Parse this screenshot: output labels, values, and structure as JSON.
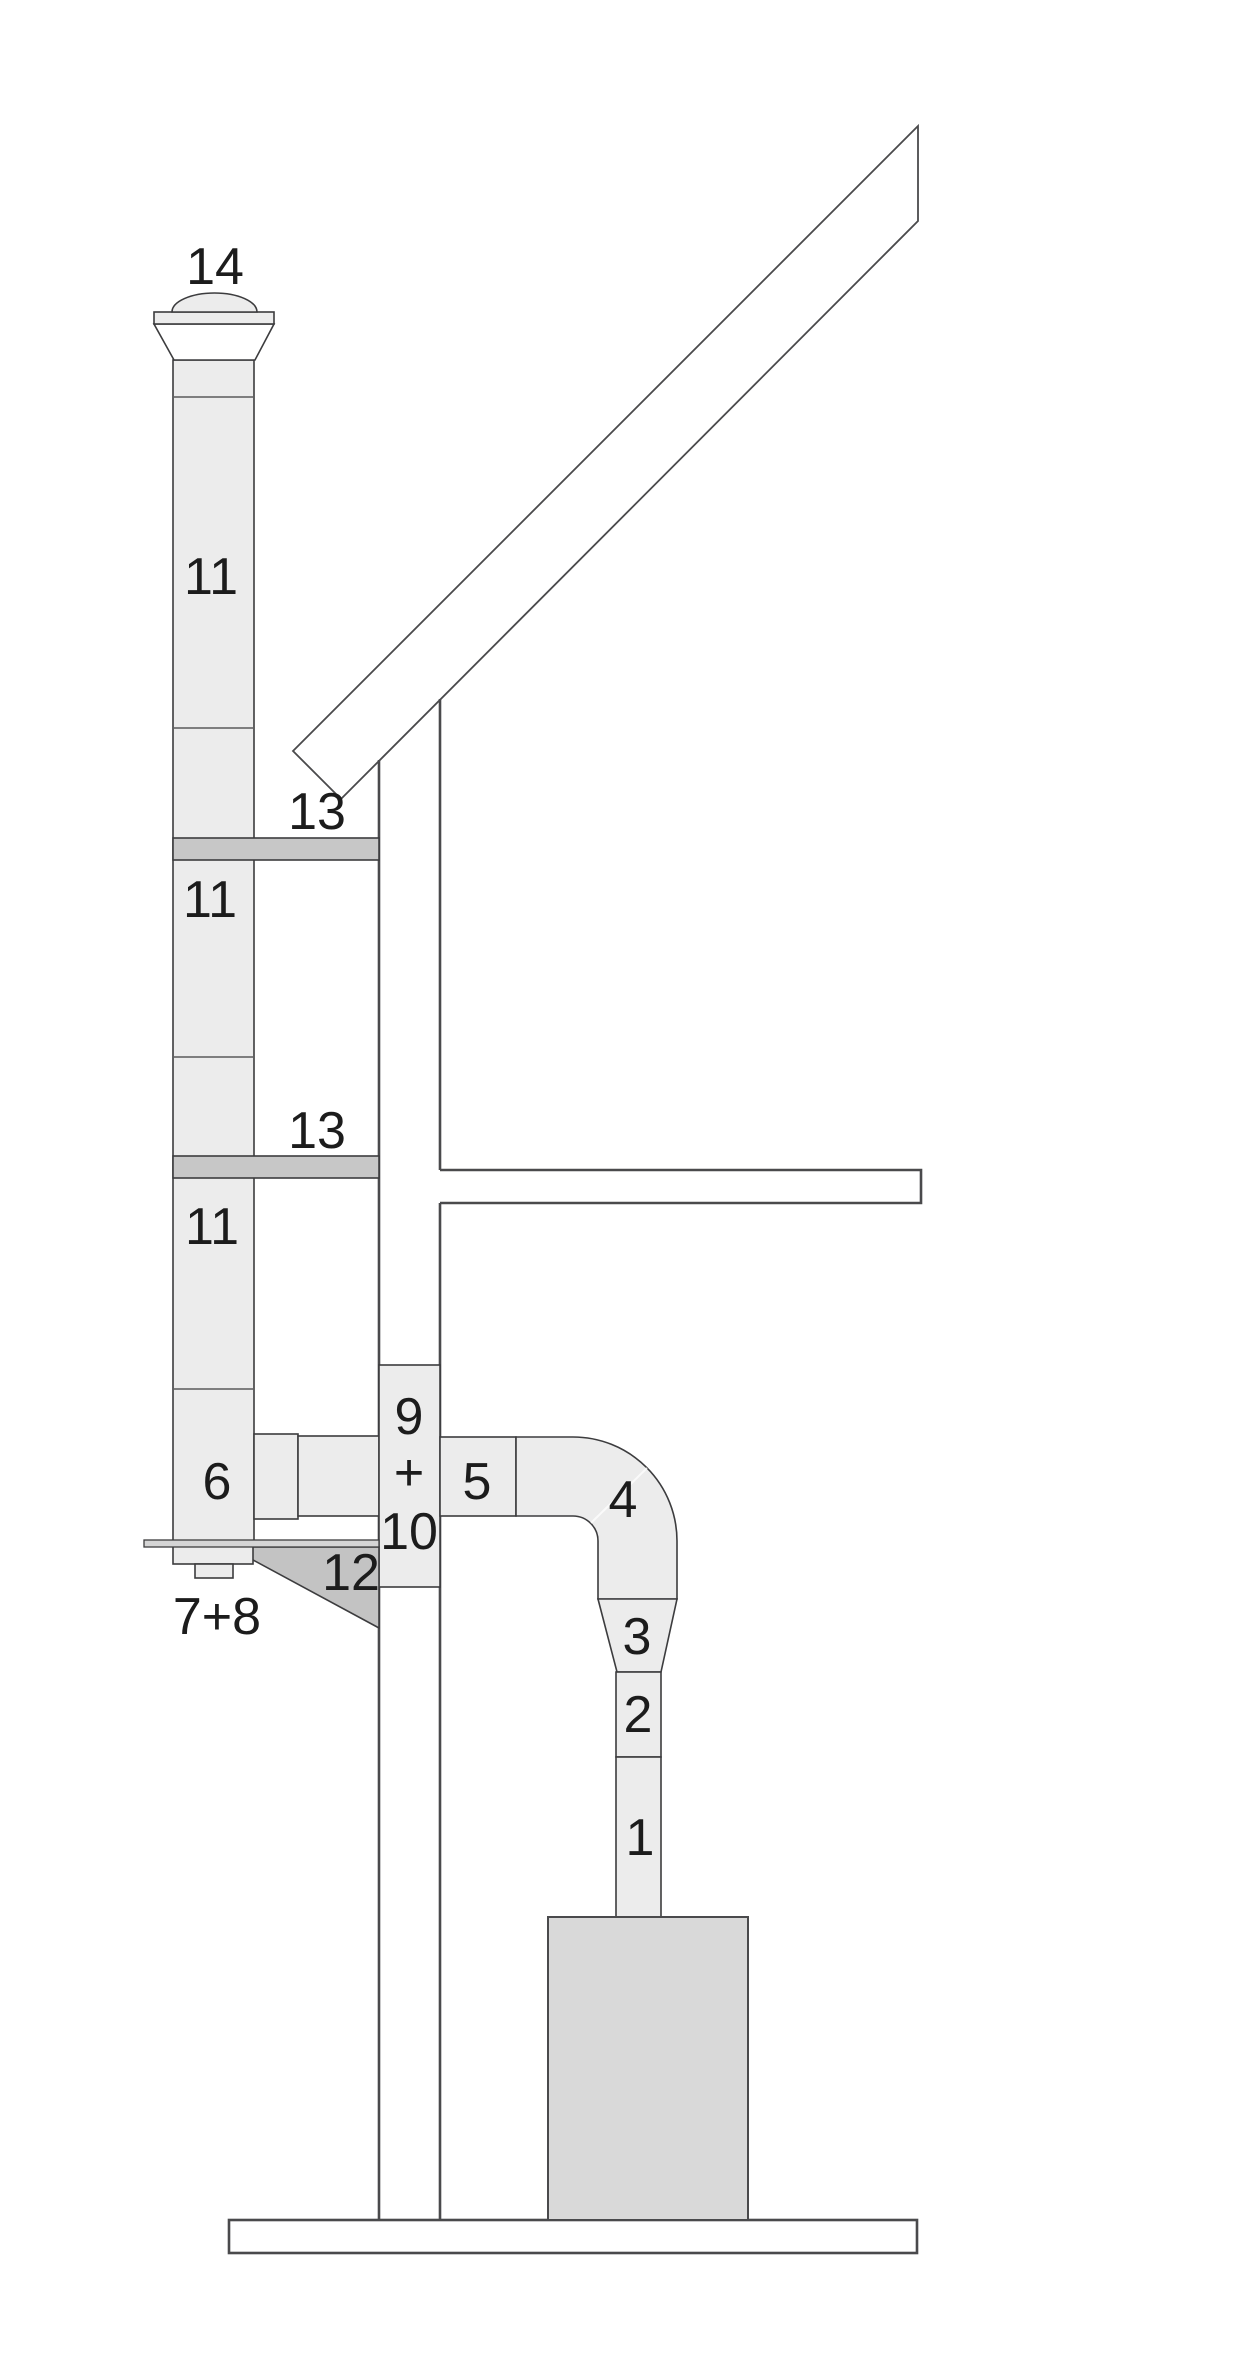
{
  "diagram": {
    "part_labels": [
      {
        "text": "14"
      },
      {
        "text": "11"
      },
      {
        "text": "13"
      },
      {
        "text": "11"
      },
      {
        "text": "13"
      },
      {
        "text": "11"
      },
      {
        "text": "9"
      },
      {
        "text": "+"
      },
      {
        "text": "10"
      },
      {
        "text": "6"
      },
      {
        "text": "5"
      },
      {
        "text": "4"
      },
      {
        "text": "12"
      },
      {
        "text": "7+8"
      },
      {
        "text": "3"
      },
      {
        "text": "2"
      },
      {
        "text": "1"
      }
    ],
    "colors": {
      "background": "#ffffff",
      "pipe_fill": "#ececec",
      "bracket_fill": "#c7c7c7",
      "console_fill": "#c3c3c3",
      "boiler_fill": "#d9d9d9",
      "plate_fill": "#d5d5d5",
      "building_stroke": "#4a4a4c",
      "pipe_stroke": "#3c3c3e",
      "label_color": "#1c1c1c"
    }
  }
}
